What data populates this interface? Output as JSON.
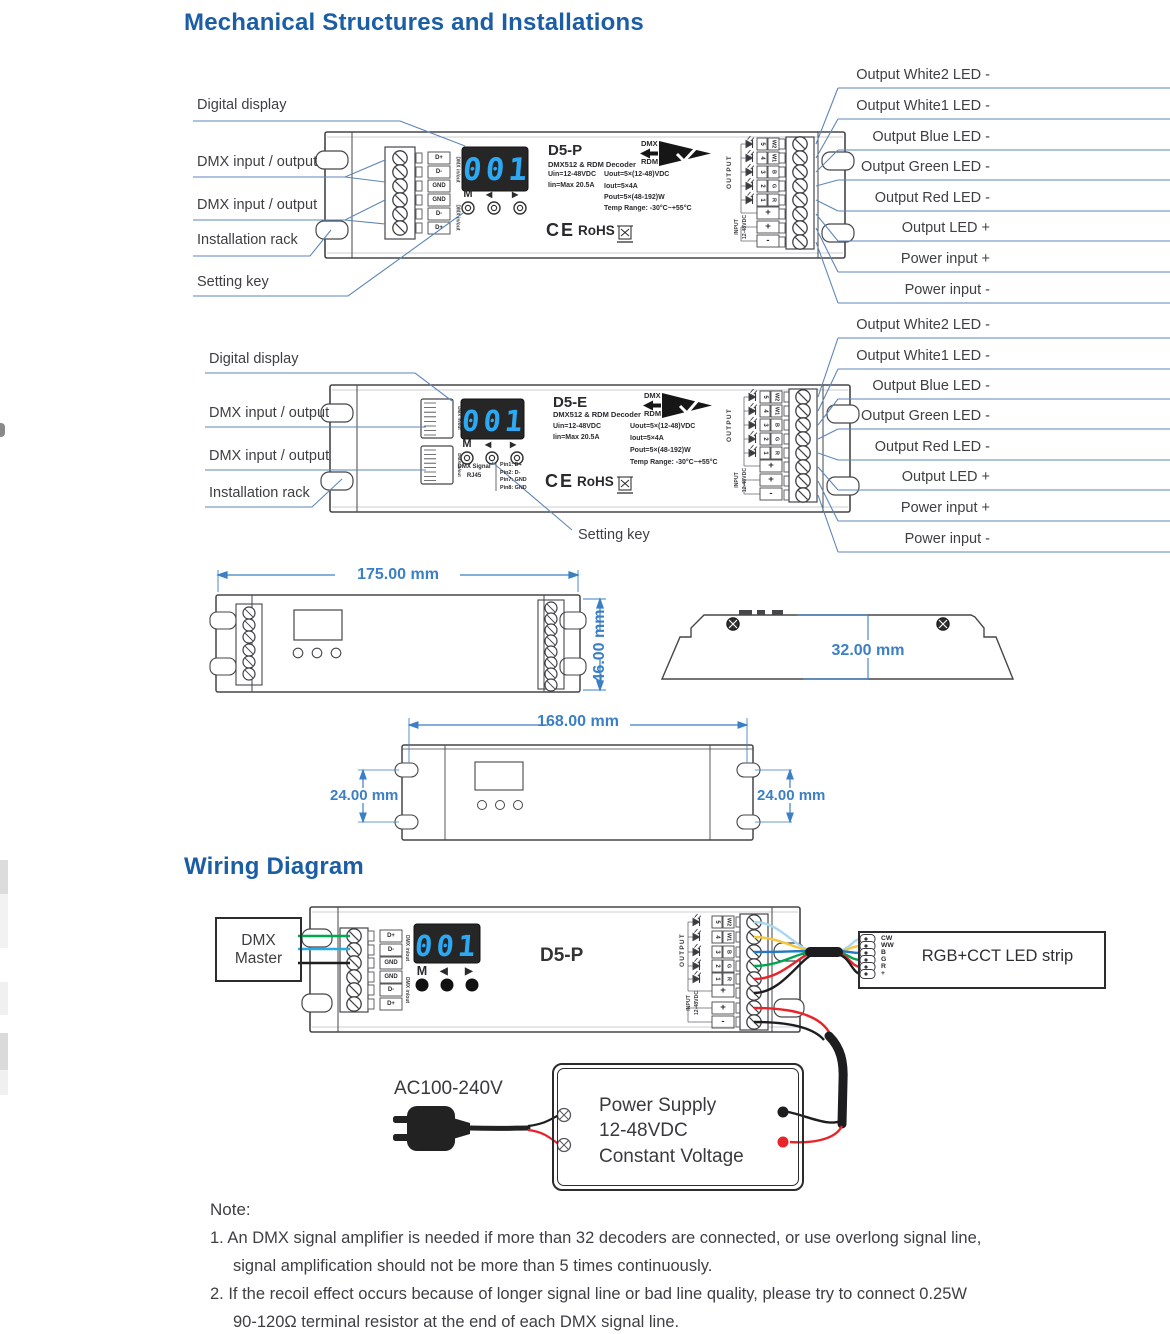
{
  "titles": {
    "mechanical": "Mechanical Structures and Installations",
    "wiring": "Wiring Diagram"
  },
  "callouts": {
    "left": [
      "Digital display",
      "DMX input / output",
      "DMX input / output",
      "Installation rack",
      "Setting key"
    ],
    "right": [
      "Output White2 LED -",
      "Output White1 LED -",
      "Output Blue LED -",
      "Output Green LED -",
      "Output Red LED -",
      "Output LED +",
      "Power input +",
      "Power input -"
    ]
  },
  "device": {
    "display": "001",
    "btn_m": "M",
    "btn_prev": "◀",
    "btn_next": "▶",
    "dmx_terminals": [
      "D+",
      "D-",
      "GND",
      "GND",
      "D-",
      "D+"
    ],
    "dmx_inout": "DMX in/out",
    "output_label": "OUTPUT",
    "input_label": "INPUT",
    "input_voltage": "12-48VDC",
    "channel_numbers": [
      "5",
      "4",
      "3",
      "2",
      "1"
    ],
    "channel_names": [
      "W2",
      "W1",
      "B",
      "G",
      "R"
    ],
    "input_terminals": [
      "+",
      "+",
      "-"
    ],
    "ce": "CE",
    "rohs": "RoHS",
    "logo": {
      "dmx": "DMX",
      "rdm": "RDM"
    }
  },
  "d5p": {
    "model": "D5-P",
    "decoder": "DMX512 & RDM Decoder",
    "specs_left": [
      "Uin=12-48VDC",
      "Iin=Max 20.5A"
    ],
    "specs_right": [
      "Uout=5×(12-48)VDC",
      "Iout=5×4A",
      "Pout=5×(48-192)W",
      "Temp Range: -30°C~+55°C"
    ]
  },
  "d5e": {
    "model": "D5-E",
    "decoder": "DMX512 & RDM Decoder",
    "specs_left": [
      "Uin=12-48VDC",
      "Iin=Max 20.5A"
    ],
    "specs_right": [
      "Uout=5×(12-48)VDC",
      "Iout=5×4A",
      "Pout=5×(48-192)W",
      "Temp Range: -30°C~+55°C"
    ],
    "rj45_line1": "DMX Signal",
    "rj45_line2": "RJ45",
    "pins": [
      "Pin1: D+",
      "Pin2: D-",
      "Pin7: GND",
      "Pin8: GND"
    ]
  },
  "dimensions": {
    "front_width": "175.00 mm",
    "front_height": "46.00 mm",
    "depth": "32.00 mm",
    "mount_width": "168.00 mm",
    "mount_left": "24.00 mm",
    "mount_right": "24.00 mm"
  },
  "wiring": {
    "master_line1": "DMX",
    "master_line2": "Master",
    "strip_label": "RGB+CCT LED strip",
    "strip_pins": [
      "CW",
      "WW",
      "B",
      "G",
      "R",
      "+"
    ],
    "ac_label": "AC100-240V",
    "psu": [
      "Power Supply",
      "12-48VDC",
      "Constant Voltage"
    ]
  },
  "note": {
    "heading": "Note:",
    "lines": [
      "1. An DMX signal amplifier is needed if more than 32 decoders are connected, or use overlong signal line,",
      "signal amplification should not be more than 5 times continuously.",
      "2. If the recoil effect occurs because of longer signal line or bad line quality, please try to connect 0.25W",
      "90-120Ω terminal resistor at the end of each DMX signal line."
    ]
  },
  "colors": {
    "heading_blue": "#1b5ea6",
    "dimension_blue": "#3b7fc4",
    "leader_blue": "#5d86b8",
    "display_digits": "#2ca9f2",
    "wire_cw": "#a8d8f0",
    "wire_ww": "#f8c63e",
    "wire_b": "#2277c6",
    "wire_g": "#00a651",
    "wire_r": "#e9232a",
    "wire_black": "#1d1d1f",
    "wire_cyan": "#29abe2"
  }
}
